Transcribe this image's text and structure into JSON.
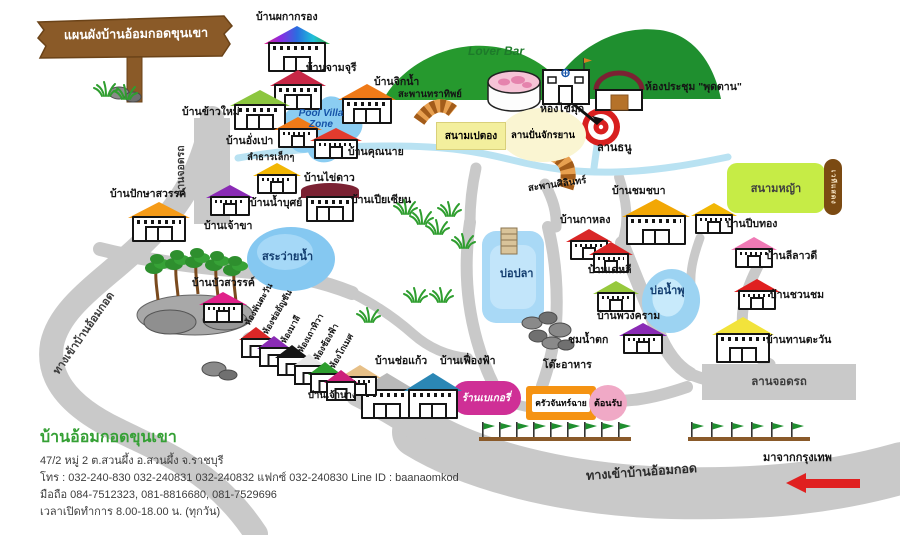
{
  "sign": {
    "title": "แผนผังบ้านอ้อมกอดขุนเขา"
  },
  "info": {
    "name": "บ้านอ้อมกอดขุนเขา",
    "address": "47/2 หมู่ 2 ต.สวนผึ้ง อ.สวนผึ้ง จ.ราชบุรี",
    "phone": "โทร : 032-240-830 032-240831 032-240832 แฟกซ์ 032-240830 Line ID : baanaomkod",
    "mobile": "มือถือ 084-7512323, 081-8816680, 081-7529696",
    "hours": "เวลาเปิดทำการ 8.00-18.00 น. (ทุกวัน)"
  },
  "labels": {
    "lover_bar": "Lover Bar",
    "pool_villa_zone": "Pool Villa Zone",
    "meeting_room": "ห้องประชุม \"พุดตาน\"",
    "pearl_room": "ห้องไข่มุก",
    "petanque": "สนามเปตอง",
    "bike_area": "ลานปั่นจักรยาน",
    "archery": "ลานธนู",
    "bridge_north": "สะพานทราทิพย์",
    "bridge_south": "สะพานศิลินทร์",
    "small_stream": "ลำธารเล็กๆ",
    "lawn": "สนามหญ้า",
    "stage": "เวทีแสดง",
    "swim_pond": "สระว่ายน้ำ",
    "fish_pond": "บ่อปลา",
    "fountain_pond": "บ่อน้ำพุ",
    "waterfall_view": "ชมน้ำตก",
    "dining_tables": "โต๊ะอาหาร",
    "kitchen": "ครัวจันทร์ฉาย",
    "reception": "ต้อนรับ",
    "bakery": "ร้านเบเกอรี่",
    "parking_right": "ลานจอดรถ",
    "parking_left": "ลานจอดรถ",
    "entrance_left": "ทางเข้าบ้านอ้อมกอด",
    "entrance_bottom": "ทางเข้าบ้านอ้อมกอด",
    "from_bangkok": "มาจากกรุงเทพ"
  },
  "houses": [
    {
      "label": "บ้านผกากรอง",
      "roof": "linear-gradient(90deg,#e0218a,#8a2be2,#2a6de0,#20c0d8,#35a835)"
    },
    {
      "label": "บ้านจามจุรี",
      "roof": "#c82846"
    },
    {
      "label": "บ้านจิกน้ำ",
      "roof": "#ef7a18"
    },
    {
      "label": "บ้านข้าวใหม่",
      "roof": "#8cc63f"
    },
    {
      "label": "บ้านอั่งเปา",
      "roof": "#ef7a18"
    },
    {
      "label": "บ้านคุณนาย",
      "roof": "#e23b2e"
    },
    {
      "label": "บ้านไข่ดาว",
      "roof": "#f2b705"
    },
    {
      "label": "บ้านเจ้าขา",
      "roof": "#8a2bb5"
    },
    {
      "label": "บ้านเปียเซียน",
      "roof": "#7b2233"
    },
    {
      "label": "บ้านปักษาสวรรค์",
      "roof": "#f59b18"
    },
    {
      "label": "บ้านบัวสวรรค์",
      "roof": "#e0218a"
    },
    {
      "label": "บ้านกาหลง",
      "roof": "#d92727"
    },
    {
      "label": "บ้านชมชบา",
      "roof": "#f2a705"
    },
    {
      "label": "บ้านเดหลี",
      "roof": "#d92727"
    },
    {
      "label": "บ้านพวงคราม",
      "roof": "#97c93d"
    },
    {
      "label": "บ้านปีบทอง",
      "roof": "#f2b705"
    },
    {
      "label": "บ้านลีลาวดี",
      "roof": "#ef7ab5"
    },
    {
      "label": "บ้านชวนชม",
      "roof": "#e02020"
    },
    {
      "label": "บ้านทานตะวัน",
      "roof": "#f2e33b"
    },
    {
      "label": "บ้านช่อแก้ว",
      "roof": "#b9b9b9"
    },
    {
      "label": "บ้านเฟื่องฟ้า",
      "roof": "#2b87b5"
    },
    {
      "label": "บ้านเจ้านาง",
      "roof": "#e7c088"
    },
    {
      "label": "",
      "roof": "#8a2bb5"
    },
    {
      "label": "บ้านน้ำบุศย์",
      "roof": "#f2b705"
    }
  ],
  "rooms": [
    {
      "label": "ห้องพันตะวัน",
      "roof": "#d92727"
    },
    {
      "label": "ห้องช่ออัญชัน",
      "roof": "#8a2bb5"
    },
    {
      "label": "ห้องมาลี",
      "roof": "#151515"
    },
    {
      "label": "ห้องเถาทิวา",
      "roof": "#e8e8e8"
    },
    {
      "label": "ห้องช้องฟ้า",
      "roof": "#2e9e2e"
    },
    {
      "label": "ห้องโกเมศ",
      "roof": "#cc1f7a"
    }
  ]
}
